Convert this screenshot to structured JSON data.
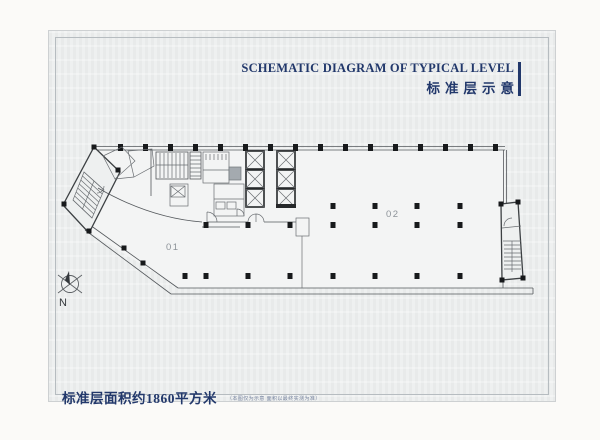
{
  "header": {
    "title_en": "SCHEMATIC DIAGRAM OF TYPICAL LEVEL",
    "title_zh": "标准层示意"
  },
  "plan": {
    "unit_01_label": "01",
    "unit_02_label": "02",
    "compass_label": "N"
  },
  "footer": {
    "area_text": "标准层面积约1860平方米",
    "fine_print": "（本图仅为示意 面积以最终实测为准）"
  },
  "colors": {
    "accent": "#22386b",
    "plan_line": "#54585c",
    "column": "#17191b",
    "unit_label": "#8d9399"
  }
}
